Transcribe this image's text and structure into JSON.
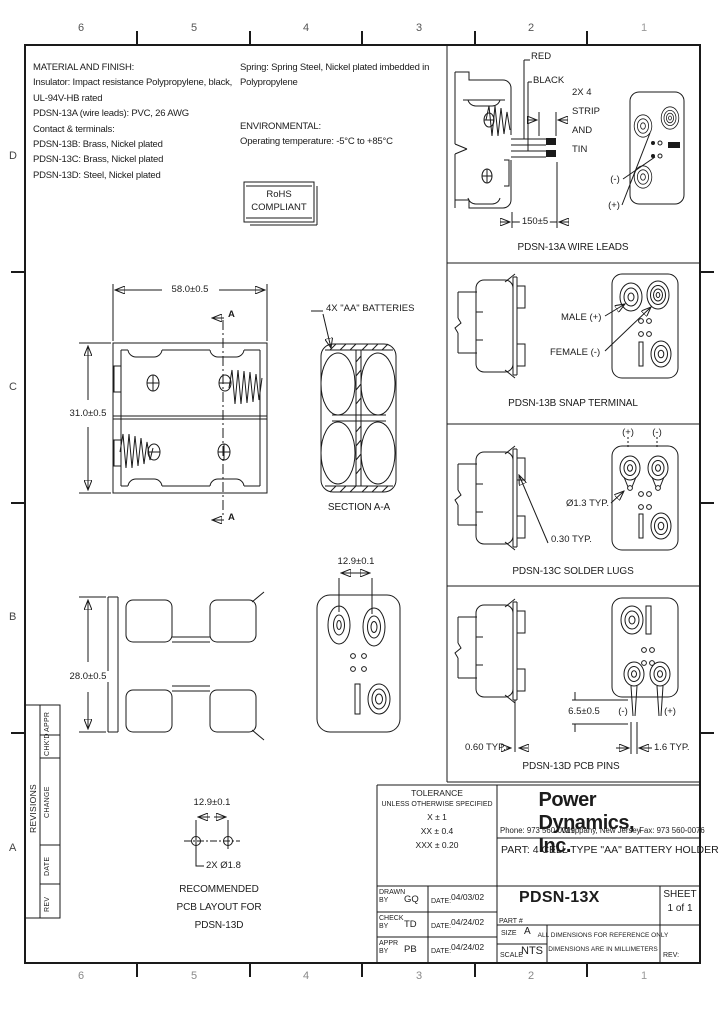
{
  "sheet": {
    "zones_top": [
      "6",
      "5",
      "4",
      "3",
      "2",
      "1"
    ],
    "zones_bottom": [
      "6",
      "5",
      "4",
      "3",
      "2",
      "1"
    ],
    "rows_left": [
      "D",
      "C",
      "B",
      "A"
    ]
  },
  "notes": {
    "material_title": "MATERIAL AND FINISH:",
    "material_line1": "Insulator: Impact resistance Polypropylene, black,",
    "material_line2": "UL-94V-HB rated",
    "material_line3": "PDSN-13A (wire leads): PVC, 26 AWG",
    "material_line4": "Contact & terminals:",
    "material_line5": "PDSN-13B: Brass, Nickel plated",
    "material_line6": "PDSN-13C: Brass, Nickel plated",
    "material_line7": "PDSN-13D: Steel, Nickel plated",
    "spring_line1": "Spring: Spring Steel, Nickel plated imbedded in",
    "spring_line2": "Polypropylene",
    "env_title": "ENVIRONMENTAL:",
    "env_line": "Operating temperature: -5°C to +85°C",
    "rohs_line1": "RoHS",
    "rohs_line2": "COMPLIANT"
  },
  "views": {
    "top_width": "58.0±0.5",
    "top_height": "31.0±0.5",
    "section_a_top": "A",
    "section_a_bottom": "A",
    "batteries_callout": "4X \"AA\" BATTERIES",
    "section_caption": "SECTION A-A",
    "side_height": "28.0±0.5",
    "end_width": "12.9±0.1",
    "pcb_dim": "12.9±0.1",
    "pcb_hole": "2X Ø1.8",
    "pcb_caption1": "RECOMMENDED",
    "pcb_caption2": "PCB LAYOUT FOR",
    "pcb_caption3": "PDSN-13D"
  },
  "panel_a": {
    "red": "RED",
    "black": "BLACK",
    "strip1": "2X 4",
    "strip2": "STRIP",
    "strip3": "AND",
    "strip4": "TIN",
    "length": "150±5",
    "neg": "(-)",
    "pos": "(+)",
    "caption": "PDSN-13A WIRE LEADS"
  },
  "panel_b": {
    "male": "MALE (+)",
    "female": "FEMALE (-)",
    "caption": "PDSN-13B SNAP TERMINAL"
  },
  "panel_c": {
    "pos": "(+)",
    "neg": "(-)",
    "hole_dia": "Ø1.3 TYP.",
    "thickness": "0.30 TYP.",
    "caption": "PDSN-13C SOLDER LUGS"
  },
  "panel_d": {
    "pin_length": "6.5±0.5",
    "neg": "(-)",
    "pos": "(+)",
    "pin_thk": "0.60 TYP.",
    "pin_w": "1.6 TYP.",
    "caption": "PDSN-13D PCB PINS"
  },
  "title_block": {
    "tol_title": "TOLERANCE",
    "tol_sub": "UNLESS OTHERWISE SPECIFIED",
    "tol_row1": "X    ±    1",
    "tol_row2": "XX    ±    0.4",
    "tol_row3": "XXX   ±   0.20",
    "company": "Power Dynamics, Inc.",
    "phone": "Phone: 973 560-0019",
    "city": "Whippany, New Jersey",
    "fax": "Fax: 973 560-0076",
    "part_desc": "PART: 4 CELL TYPE \"AA\" BATTERY HOLDER",
    "drawn_by": "DRAWN BY",
    "drawn_name": "GQ",
    "drawn_date_label": "DATE:",
    "drawn_date": "04/03/02",
    "check_by": "CHECK BY",
    "check_name": "TD",
    "check_date_label": "DATE:",
    "check_date": "04/24/02",
    "appr_by": "APPR BY",
    "appr_name": "PB",
    "appr_date_label": "DATE:",
    "appr_date": "04/24/02",
    "part_label": "PART #",
    "part_no": "PDSN-13X",
    "sheet_label": "SHEET",
    "sheet_no": "1 of 1",
    "size_label": "SIZE",
    "size": "A",
    "scale_label": "SCALE",
    "scale": "NTS",
    "note1": "ALL DIMENSIONS FOR REFERENCE ONLY",
    "note2": "DIMENSIONS ARE IN MILLIMETERS",
    "rev_label": "REV:"
  },
  "revisions": {
    "title": "REVISIONS",
    "col_appr": "APPR",
    "col_chkd": "CHK'D",
    "col_change": "CHANGE",
    "col_date": "DATE",
    "col_rev": "REV"
  }
}
